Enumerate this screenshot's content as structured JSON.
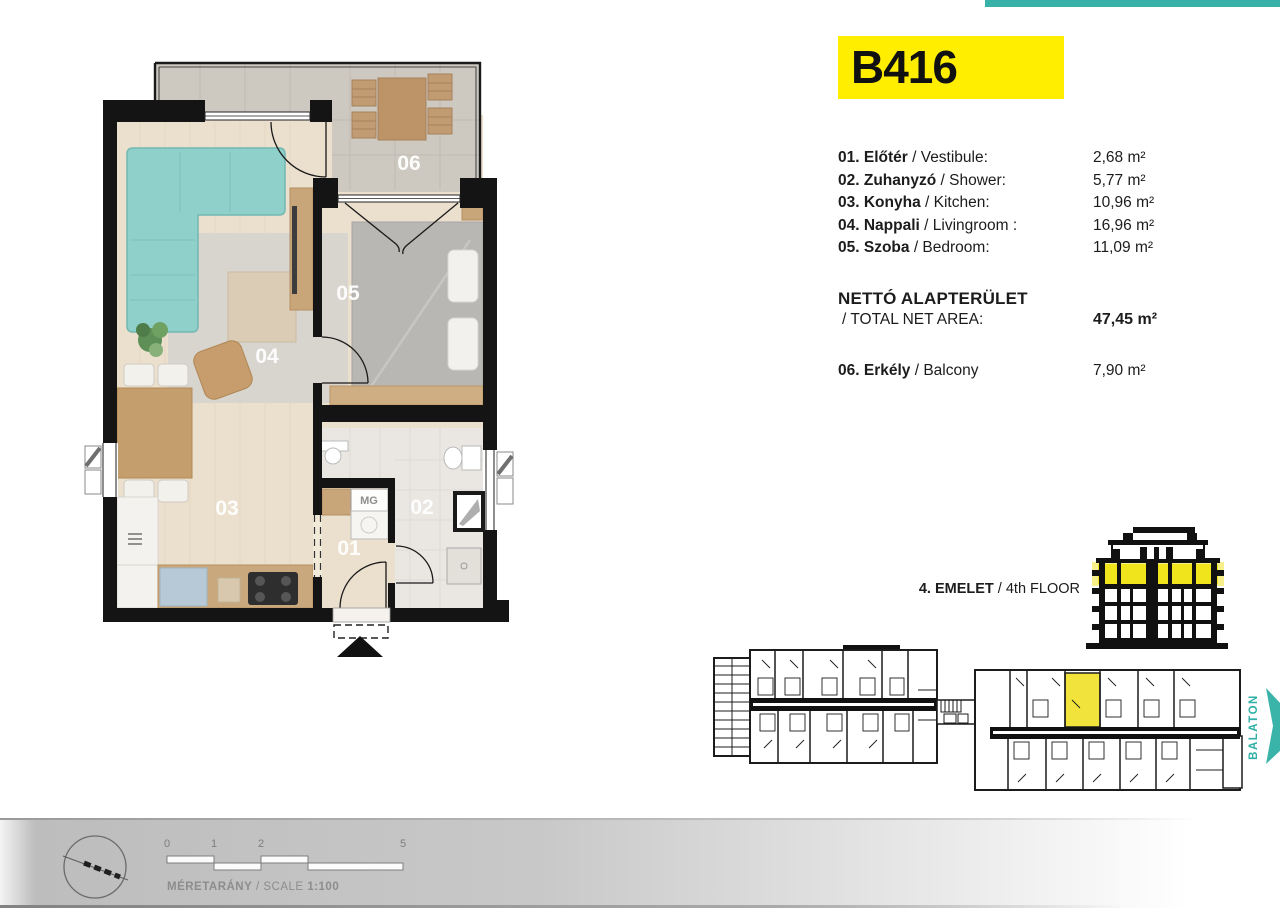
{
  "top_bar": {
    "color": "#38b2a8"
  },
  "unit_card": {
    "id": "B416",
    "bg": "#ffee00"
  },
  "room_list": [
    {
      "bold": "01. Előtér",
      "rest": "/ Vestibule:",
      "area": "2,68 m²"
    },
    {
      "bold": "02. Zuhanyzó",
      "rest": "/ Shower:",
      "area": "5,77 m²"
    },
    {
      "bold": "03. Konyha",
      "rest": "/ Kitchen:",
      "area": "10,96 m²"
    },
    {
      "bold": "04. Nappali",
      "rest": "/ Livingroom :",
      "area": "16,96 m²"
    },
    {
      "bold": "05. Szoba",
      "rest": "/ Bedroom:",
      "area": "11,09 m²"
    }
  ],
  "total": {
    "hu": "NETTÓ ALAPTERÜLET",
    "en": "/ TOTAL NET AREA:",
    "value": "47,45 m²"
  },
  "balcony_row": {
    "bold": "06. Erkély",
    "rest": "/ Balcony",
    "area": "7,90 m²"
  },
  "floor_indicator": {
    "bold": "4. EMELET",
    "rest": "/ 4th FLOOR"
  },
  "plan_labels": {
    "r01": "01",
    "r02": "02",
    "r03": "03",
    "r04": "04",
    "r05": "05",
    "r06": "06",
    "mg": "MG"
  },
  "site": {
    "direction": "BALATON",
    "teal": "#35b2a8",
    "highlight": "#f2e33c"
  },
  "footer": {
    "ticks": [
      "0",
      "1",
      "2",
      "5"
    ],
    "label_bold": "MÉRETARÁNY",
    "label_mid": "/ SCALE",
    "label_ratio": "1:100"
  }
}
